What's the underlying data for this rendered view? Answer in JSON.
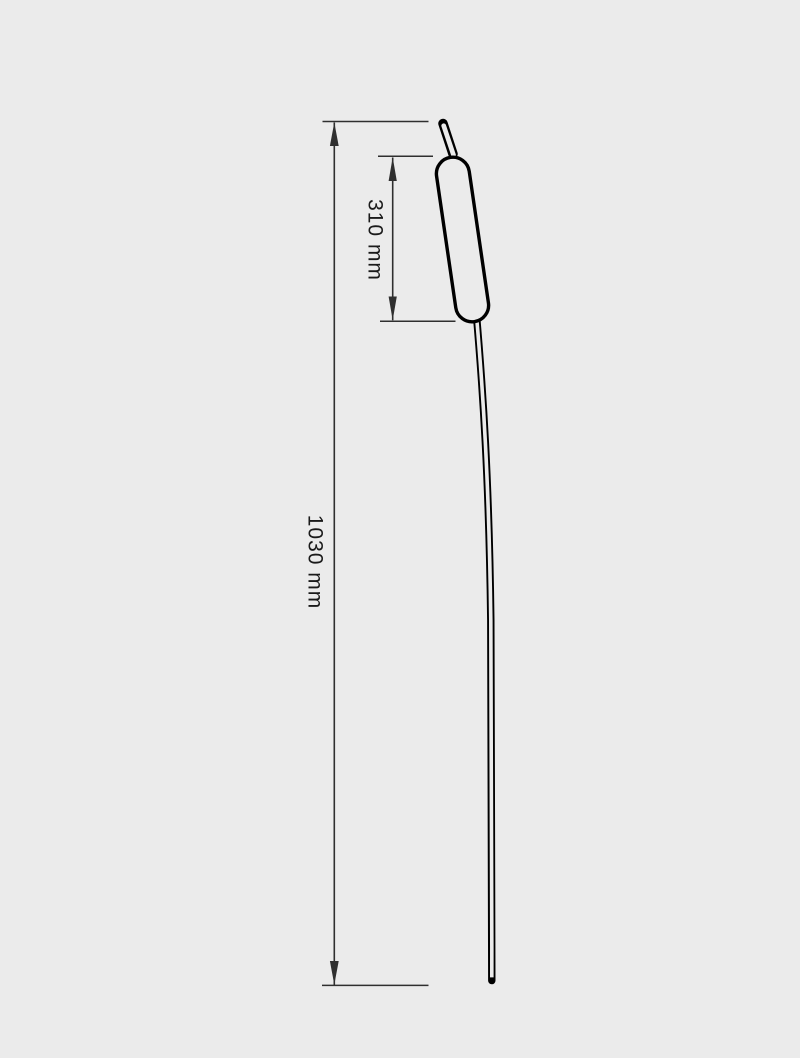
{
  "page": {
    "background": "#ebebeb",
    "description": "technical line drawing of a cattail with dimensions"
  },
  "colors": {
    "bg": "#ebebeb",
    "outline": "#000000",
    "dim": "#2f2f2f",
    "ink": "#1a1a1a"
  },
  "dimensions": {
    "overall": {
      "label": "1030 mm"
    },
    "head": {
      "label": "310 mm"
    }
  }
}
